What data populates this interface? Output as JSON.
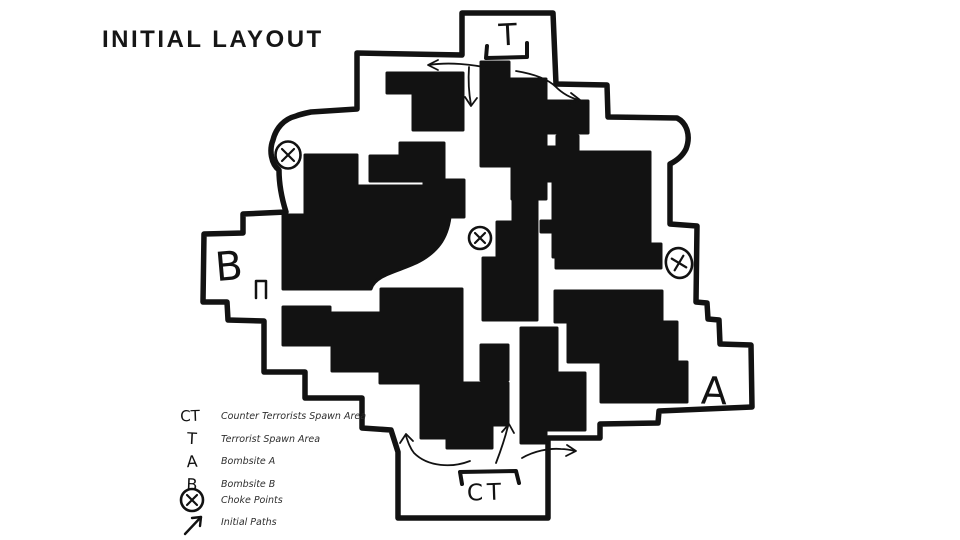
{
  "title": "INITIAL LAYOUT",
  "colors": {
    "ink": "#121212",
    "paper": "#ffffff"
  },
  "map": {
    "labels": {
      "t_spawn": "T",
      "ct_spawn": "CT",
      "site_a": "A",
      "site_b": "B"
    },
    "choke_point_count": 3,
    "initial_path_arrow_count": 6
  },
  "legend": {
    "items": [
      {
        "symbol": "CT",
        "label": "Counter Terrorists Spawn Area"
      },
      {
        "symbol": "T",
        "label": "Terrorist Spawn Area"
      },
      {
        "symbol": "A",
        "label": "Bombsite A"
      },
      {
        "symbol": "B",
        "label": "Bombsite B"
      },
      {
        "symbol": "choke-point-icon",
        "label": "Choke Points"
      },
      {
        "symbol": "initial-path-icon",
        "label": "Initial Paths"
      }
    ]
  }
}
